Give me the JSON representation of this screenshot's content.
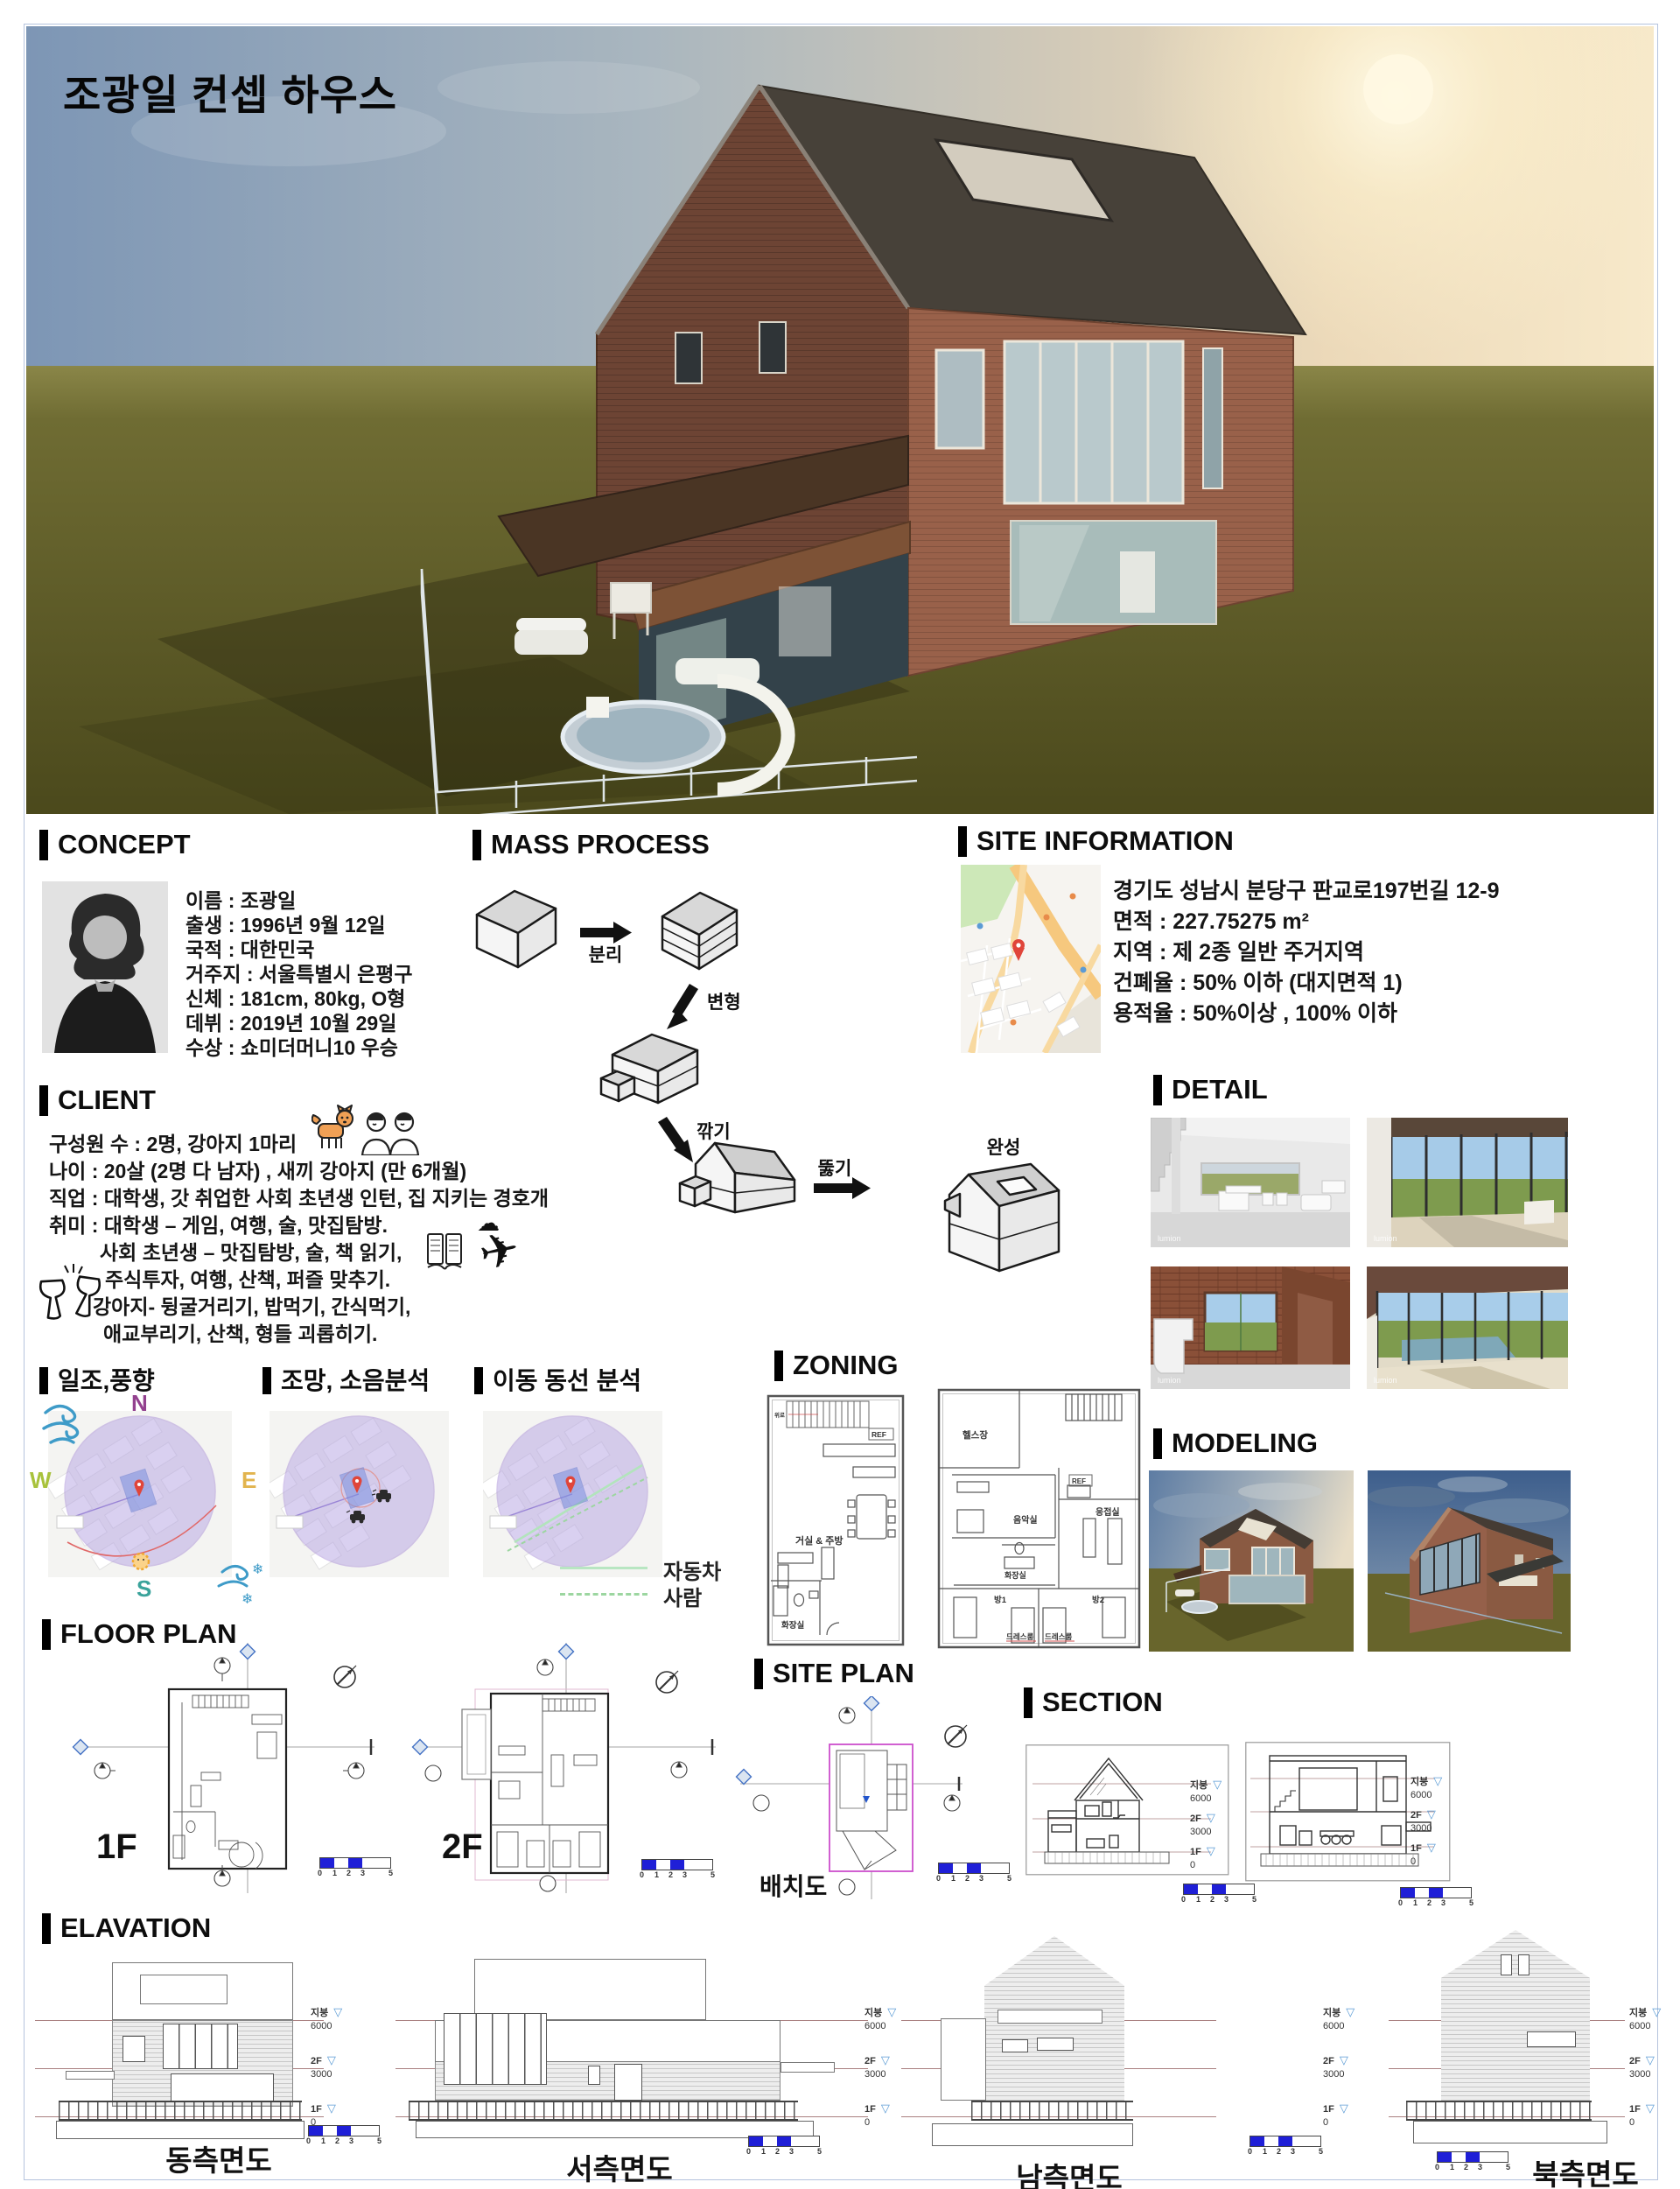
{
  "page": {
    "title": "조광일 컨셉 하우스"
  },
  "concept": {
    "title": "CONCEPT",
    "profile": [
      "이름 : 조광일",
      "출생 : 1996년 9월 12일",
      "국적 : 대한민국",
      "거주지 : 서울특별시 은평구",
      "신체 : 181cm, 80kg, O형",
      "데뷔 : 2019년 10월 29일",
      "수상 : 쇼미더머니10 우승"
    ]
  },
  "mass_process": {
    "title": "MASS PROCESS",
    "steps": [
      "분리",
      "변형",
      "깎기",
      "뚫기"
    ],
    "final": "완성"
  },
  "site_information": {
    "title": "SITE INFORMATION",
    "lines": [
      "경기도 성남시 분당구 판교로197번길 12-9",
      "면적 : 227.75275 m²",
      "지역 : 제 2종 일반 주거지역",
      "건폐율 : 50% 이하 (대지면적 1)",
      "용적율 : 50%이상 , 100% 이하"
    ]
  },
  "client": {
    "title": "CLIENT",
    "lines": [
      "구성원 수 : 2명, 강아지 1마리",
      "나이 : 20살 (2명 다 남자) , 새끼 강아지 (만 6개월)",
      "직업 : 대학생, 갓 취업한 사회 초년생 인턴, 집 지키는 경호개",
      "취미 : 대학생 – 게임, 여행, 술, 맛집탐방.",
      "사회 초년생 – 맛집탐방, 술, 책 읽기,",
      "주식투자, 여행, 산책, 퍼즐 맞추기.",
      "강아지- 뒹굴거리기, 밥먹기, 간식먹기,",
      "애교부리기, 산책, 형들 괴롭히기."
    ]
  },
  "analysis": {
    "sun_wind_title": "일조,풍향",
    "view_noise_title": "조망, 소음분석",
    "circulation_title": "이동 동선 분석",
    "compass": {
      "n": "N",
      "e": "E",
      "s": "S",
      "w": "W"
    },
    "legend": {
      "car": "자동차",
      "person": "사람"
    }
  },
  "zoning": {
    "title": "ZONING",
    "floor1": {
      "rooms": [
        "거실 & 주방",
        "화장실"
      ],
      "stair_label": "위로",
      "fridge": "REF"
    },
    "floor2": {
      "rooms": [
        "헬스장",
        "음악실",
        "응접실",
        "화장실",
        "방1",
        "방2",
        "드레스룸",
        "드레스룸"
      ],
      "fridge": "REF"
    }
  },
  "detail": {
    "title": "DETAIL",
    "watermark": "lumion"
  },
  "modeling": {
    "title": "MODELING"
  },
  "floor_plan": {
    "title": "FLOOR PLAN",
    "f1": "1F",
    "f2": "2F"
  },
  "site_plan": {
    "title": "SITE PLAN",
    "caption": "배치도"
  },
  "section": {
    "title": "SECTION"
  },
  "elevation": {
    "title": "ELAVATION",
    "views": [
      "동측면도",
      "서측면도",
      "남측면도",
      "북측면도"
    ]
  },
  "levels": [
    {
      "name": "지붕",
      "elev": "6000"
    },
    {
      "name": "2F",
      "elev": "3000"
    },
    {
      "name": "1F",
      "elev": "0"
    }
  ],
  "scalebar": {
    "ticks": [
      "0",
      "1",
      "2",
      "3",
      "5"
    ]
  },
  "colors": {
    "accent_blue": "#1f1fd7",
    "magenta": "#cc4fcc",
    "purple_zone": "#b5a3e3",
    "level_line": "#aa8080",
    "map_road": "#f6c87e",
    "brick": "#8a5a45"
  }
}
